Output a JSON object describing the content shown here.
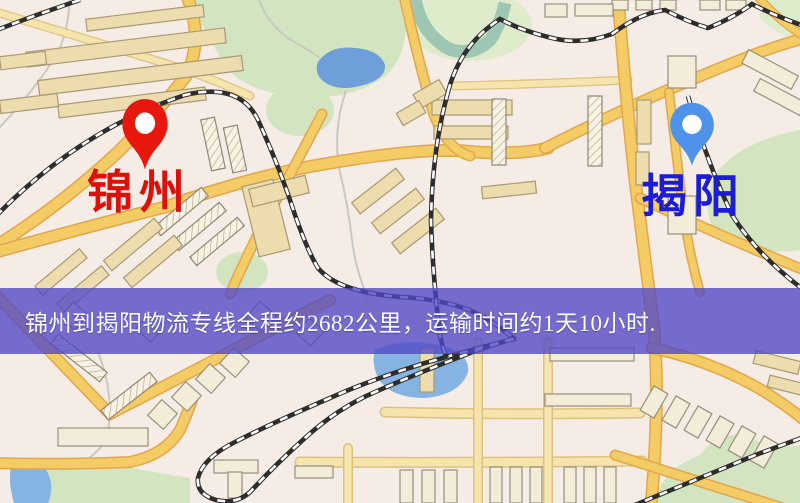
{
  "banner": {
    "text": "锦州到揭阳物流专线全程约2682公里，运输时间约1天10小时.",
    "background_color": "#4f46c7",
    "text_color": "#ffffff"
  },
  "markers": {
    "origin": {
      "label": "锦州",
      "pin_color": "#e8170e",
      "label_color": "#dd100c"
    },
    "destination": {
      "label": "揭阳",
      "pin_color": "#4e92ea",
      "label_color": "#1c1cd6"
    }
  },
  "map_palette": {
    "background": "#f5ece5",
    "road_major": "#f4cc66",
    "road_casing": "#e2a64d",
    "road_minor": "#f6e4ad",
    "park_green": "#d3e5c0",
    "water_blue": "#6f9fd8",
    "railway_dark": "#2e2d2b",
    "building_tan": "#ecdcae"
  }
}
